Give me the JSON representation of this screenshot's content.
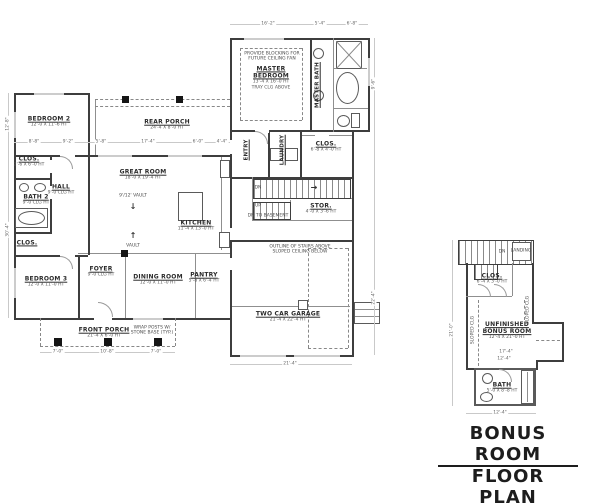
{
  "meta": {
    "background_color": "#ffffff",
    "wall_color": "#3e3e3e",
    "text_color": "#2b2b2b",
    "dim_color": "#666666"
  },
  "title": {
    "line1": "BONUS ROOM",
    "line2": "FLOOR PLAN"
  },
  "labels": [
    {
      "id": "bedroom-2",
      "t": "BEDROOM 2",
      "s": "12'-0 X 11'-6 HT",
      "x": 49,
      "y": 122,
      "cls": "room"
    },
    {
      "id": "rear-porch",
      "t": "REAR PORCH",
      "s": "24'-4 X 8'-0 HT",
      "x": 167,
      "y": 125,
      "cls": "room"
    },
    {
      "id": "master-bedroom",
      "t": "MASTER\nBEDROOM",
      "s": "13'-4 X 16'-0 HT\nTRAY CLG ABOVE",
      "x": 271,
      "y": 78,
      "cls": "room"
    },
    {
      "id": "ceiling-fan-note",
      "t": "PROVIDE BLOCKING FOR\nFUTURE CEILING FAN",
      "x": 272,
      "y": 57,
      "cls": "note"
    },
    {
      "id": "master-bath",
      "t": "MASTER BATH",
      "x": 318,
      "y": 85,
      "cls": "roomv",
      "rot": -90
    },
    {
      "id": "entry",
      "t": "ENTRY",
      "x": 247,
      "y": 150,
      "cls": "roomv",
      "rot": -90
    },
    {
      "id": "laundry",
      "t": "LAUNDRY",
      "x": 283,
      "y": 150,
      "cls": "roomv",
      "rot": -90
    },
    {
      "id": "master-closet",
      "t": "CLOS.",
      "s": "6'-8 X 4'-0 HT",
      "x": 326,
      "y": 147,
      "cls": "room"
    },
    {
      "id": "great-room",
      "t": "GREAT ROOM",
      "s": "18'-0 X 19'-4 HT",
      "x": 143,
      "y": 175,
      "cls": "room"
    },
    {
      "id": "vault-note-upper",
      "t": "9'/12' VAULT",
      "x": 133,
      "y": 196,
      "cls": "note"
    },
    {
      "id": "vault-arrow-down",
      "t": "↓",
      "x": 133,
      "y": 207,
      "cls": "arrow"
    },
    {
      "id": "vault-arrow-up",
      "t": "↑",
      "x": 133,
      "y": 236,
      "cls": "arrow"
    },
    {
      "id": "vault-note-lower",
      "t": "VAULT",
      "x": 133,
      "y": 246,
      "cls": "note"
    },
    {
      "id": "kitchen",
      "t": "KITCHEN",
      "s": "11'-4 X 13'-0 HT",
      "x": 196,
      "y": 226,
      "cls": "room"
    },
    {
      "id": "hall",
      "t": "HALL",
      "s": "9'-0 CLG HT",
      "x": 61,
      "y": 190,
      "cls": "room"
    },
    {
      "id": "bath-2",
      "t": "BATH 2",
      "s": "9'-0 CLG HT",
      "x": 36,
      "y": 200,
      "cls": "room"
    },
    {
      "id": "closet-1",
      "t": "CLOS.",
      "s": "2'-6 X 6'-0 HT",
      "x": 29,
      "y": 162,
      "cls": "room"
    },
    {
      "id": "closet-2",
      "t": "CLOS.",
      "x": 27,
      "y": 243,
      "cls": "room"
    },
    {
      "id": "bedroom-3",
      "t": "BEDROOM 3",
      "s": "12'-0 X 11'-0 HT",
      "x": 46,
      "y": 282,
      "cls": "room"
    },
    {
      "id": "foyer",
      "t": "FOYER",
      "s": "9'-0 CLG HT",
      "x": 101,
      "y": 272,
      "cls": "room"
    },
    {
      "id": "dining-room",
      "t": "DINING ROOM",
      "s": "12'-0 X 11'-0 HT",
      "x": 158,
      "y": 280,
      "cls": "room"
    },
    {
      "id": "pantry",
      "t": "PANTRY",
      "s": "5'-8 X 6'-4 HT",
      "x": 204,
      "y": 278,
      "cls": "room"
    },
    {
      "id": "front-porch",
      "t": "FRONT PORCH",
      "s": "21'-4 X 6'-0 HT",
      "x": 104,
      "y": 333,
      "cls": "room"
    },
    {
      "id": "porch-post-note",
      "t": "WRAP POSTS W/\nSTONE BASE (TYP.)",
      "x": 152,
      "y": 331,
      "cls": "note"
    },
    {
      "id": "two-car-garage",
      "t": "TWO CAR GARAGE",
      "s": "21'-4 X 22'-4 HT",
      "x": 288,
      "y": 317,
      "cls": "room"
    },
    {
      "id": "garage-stairs-note",
      "t": "OUTLINE OF STAIRS ABOVE\nSLOPED CEILING BELOW",
      "x": 300,
      "y": 250,
      "cls": "note"
    },
    {
      "id": "storage",
      "t": "STOR.",
      "s": "4'-0 X 3'-6 HT",
      "x": 321,
      "y": 209,
      "cls": "room"
    },
    {
      "id": "stairs-dn",
      "t": "DN",
      "x": 258,
      "y": 188,
      "cls": "note"
    },
    {
      "id": "stairs-arrow",
      "t": "→",
      "x": 314,
      "y": 188,
      "cls": "arrow"
    },
    {
      "id": "stairs-up",
      "t": "UP",
      "x": 258,
      "y": 206,
      "cls": "note"
    },
    {
      "id": "dn-to-basement",
      "t": "DN TO BASEMENT",
      "x": 268,
      "y": 216,
      "cls": "note"
    },
    {
      "id": "bonus-closet",
      "t": "CLOS.",
      "s": "6'-4 X 3'-0 HT",
      "x": 492,
      "y": 279,
      "cls": "room"
    },
    {
      "id": "unfinished-bonus-room",
      "t": "UNFINISHED\nBONUS ROOM",
      "s": "12'-4 X 21'-0 HT",
      "x": 507,
      "y": 331,
      "cls": "room"
    },
    {
      "id": "bonus-bath",
      "t": "BATH",
      "s": "5'-0 X 8'-8 HT",
      "x": 502,
      "y": 388,
      "cls": "room"
    },
    {
      "id": "sloped-clg-left",
      "t": "SLOPED CLG",
      "x": 473,
      "y": 330,
      "cls": "note",
      "rot": -90
    },
    {
      "id": "sloped-clg-right",
      "t": "SLOPED CLG",
      "x": 528,
      "y": 310,
      "cls": "note",
      "rot": -90
    },
    {
      "id": "bonus-stairs-dn",
      "t": "DN",
      "x": 502,
      "y": 252,
      "cls": "note"
    },
    {
      "id": "bonus-landing",
      "t": "LANDING",
      "x": 521,
      "y": 251,
      "cls": "note"
    }
  ],
  "dims": [
    {
      "t": "8'-8\"",
      "x": 34,
      "y": 142
    },
    {
      "t": "9'-2\"",
      "x": 68,
      "y": 142
    },
    {
      "t": "5'-8\"",
      "x": 101,
      "y": 142
    },
    {
      "t": "17'-4\"",
      "x": 148,
      "y": 142
    },
    {
      "t": "6'-0\"",
      "x": 198,
      "y": 142
    },
    {
      "t": "4'-4\"",
      "x": 222,
      "y": 142
    },
    {
      "t": "16'-2\"",
      "x": 268,
      "y": 24
    },
    {
      "t": "5'-4\"",
      "x": 320,
      "y": 24
    },
    {
      "t": "6'-8\"",
      "x": 352,
      "y": 24
    },
    {
      "t": "12'-8\"",
      "x": 8,
      "y": 124,
      "r": -90
    },
    {
      "t": "30'-4\"",
      "x": 8,
      "y": 230,
      "r": -90
    },
    {
      "t": "9'-6\"",
      "x": 374,
      "y": 84,
      "r": -90
    },
    {
      "t": "22'-4\"",
      "x": 374,
      "y": 298,
      "r": -90
    },
    {
      "t": "7'-0\"",
      "x": 58,
      "y": 352
    },
    {
      "t": "10'-8\"",
      "x": 107,
      "y": 352
    },
    {
      "t": "7'-0\"",
      "x": 156,
      "y": 352
    },
    {
      "t": "21'-4\"",
      "x": 290,
      "y": 364
    },
    {
      "t": "21'-0\"",
      "x": 452,
      "y": 330,
      "r": -90
    },
    {
      "t": "17'-4\"",
      "x": 506,
      "y": 352
    },
    {
      "t": "12'-4\"",
      "x": 504,
      "y": 359
    },
    {
      "t": "12'-4\"",
      "x": 500,
      "y": 413
    }
  ]
}
